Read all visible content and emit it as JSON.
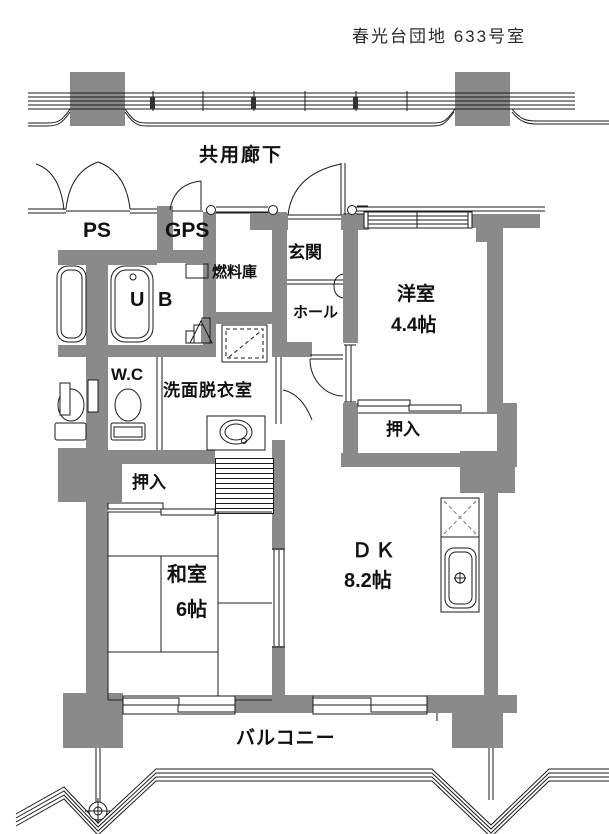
{
  "title": "春光台団地 633号室",
  "labels": {
    "corridor": "共用廊下",
    "ps": "PS",
    "gps": "GPS",
    "fuel_storage": "燃料庫",
    "entrance": "玄関",
    "hall": "ホール",
    "unit_bath": "U B",
    "toilet": "W.C",
    "washroom": "洗面脱衣室",
    "western_room": "洋室",
    "western_room_size": "4.4帖",
    "closet_west": "押入",
    "closet_japanese": "押入",
    "japanese_room": "和室",
    "japanese_room_size": "6帖",
    "dining_kitchen": "ＤＫ",
    "dining_kitchen_size": "8.2帖",
    "balcony": "バルコニー"
  },
  "colors": {
    "wall": "#8a8a8a",
    "line": "#1a1a1a",
    "background": "#ffffff",
    "text": "#111111"
  }
}
